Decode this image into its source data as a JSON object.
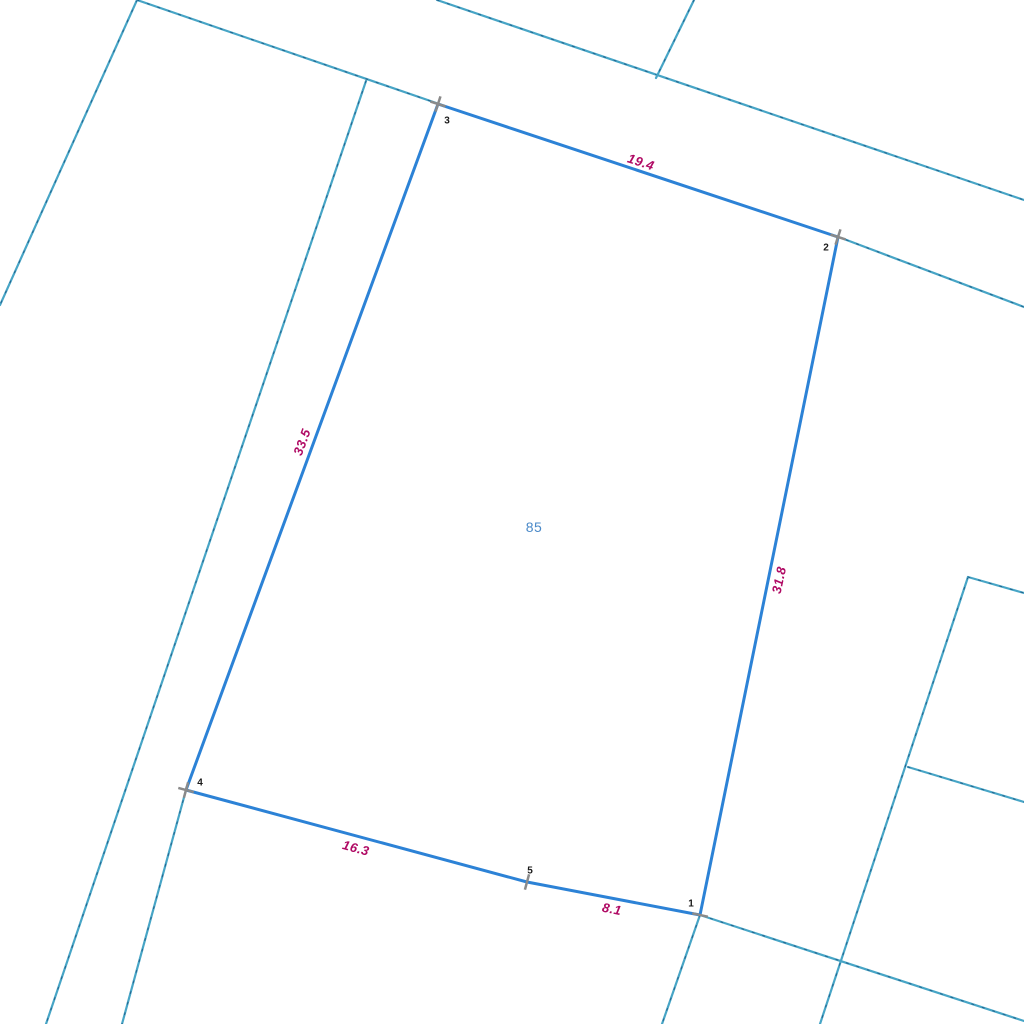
{
  "canvas": {
    "width": 1024,
    "height": 1024,
    "background": "#ffffff"
  },
  "colors": {
    "parcel_edge": "#2c82d6",
    "boundary_line": "#47a5c6",
    "boundary_dash": "#23628c",
    "vertex_marker": "#8a8a8a",
    "vertex_label": "#1a1a1a",
    "length_label": "#b00a64",
    "parcel_number": "#4a89c8"
  },
  "parcel": {
    "number": "85",
    "number_pos": {
      "x": 534,
      "y": 527
    },
    "vertices": [
      {
        "id": "1",
        "x": 700,
        "y": 915,
        "label_x": 691,
        "label_y": 904,
        "marker": "tick",
        "marker_angle": 12
      },
      {
        "id": "2",
        "x": 838,
        "y": 237,
        "label_x": 826,
        "label_y": 248,
        "marker": "cross",
        "marker_angle": 18
      },
      {
        "id": "3",
        "x": 438,
        "y": 104,
        "label_x": 447,
        "label_y": 121,
        "marker": "cross",
        "marker_angle": 18
      },
      {
        "id": "4",
        "x": 186,
        "y": 790,
        "label_x": 200,
        "label_y": 783,
        "marker": "cross",
        "marker_angle": 15
      },
      {
        "id": "5",
        "x": 527,
        "y": 882,
        "label_x": 530,
        "label_y": 871,
        "marker": "tick",
        "marker_angle": 105
      }
    ],
    "edges": [
      {
        "from": "3",
        "to": "2",
        "length": "19.4",
        "label_x": 641,
        "label_y": 162,
        "angle": 18
      },
      {
        "from": "2",
        "to": "1",
        "length": "31.8",
        "label_x": 779,
        "label_y": 580,
        "angle": -78
      },
      {
        "from": "1",
        "to": "5",
        "length": "8.1",
        "label_x": 612,
        "label_y": 909,
        "angle": 11
      },
      {
        "from": "5",
        "to": "4",
        "length": "16.3",
        "label_x": 356,
        "label_y": 848,
        "angle": 15
      },
      {
        "from": "4",
        "to": "3",
        "length": "33.5",
        "label_x": 302,
        "label_y": 442,
        "angle": -70
      }
    ]
  },
  "boundary_lines": [
    {
      "x1": 137,
      "y1": 0,
      "x2": 0,
      "y2": 305
    },
    {
      "x1": 137,
      "y1": 0,
      "x2": 445,
      "y2": 106
    },
    {
      "x1": 836,
      "y1": 236,
      "x2": 1024,
      "y2": 307
    },
    {
      "x1": 366,
      "y1": 81,
      "x2": 46,
      "y2": 1024
    },
    {
      "x1": 437,
      "y1": 0,
      "x2": 1024,
      "y2": 200
    },
    {
      "x1": 694,
      "y1": 0,
      "x2": 656,
      "y2": 78
    },
    {
      "x1": 968,
      "y1": 577,
      "x2": 820,
      "y2": 1024
    },
    {
      "x1": 968,
      "y1": 577,
      "x2": 1024,
      "y2": 593
    },
    {
      "x1": 908,
      "y1": 767,
      "x2": 1024,
      "y2": 802
    },
    {
      "x1": 186,
      "y1": 790,
      "x2": 122,
      "y2": 1024
    },
    {
      "x1": 700,
      "y1": 915,
      "x2": 662,
      "y2": 1024
    },
    {
      "x1": 700,
      "y1": 915,
      "x2": 1024,
      "y2": 1021
    }
  ]
}
